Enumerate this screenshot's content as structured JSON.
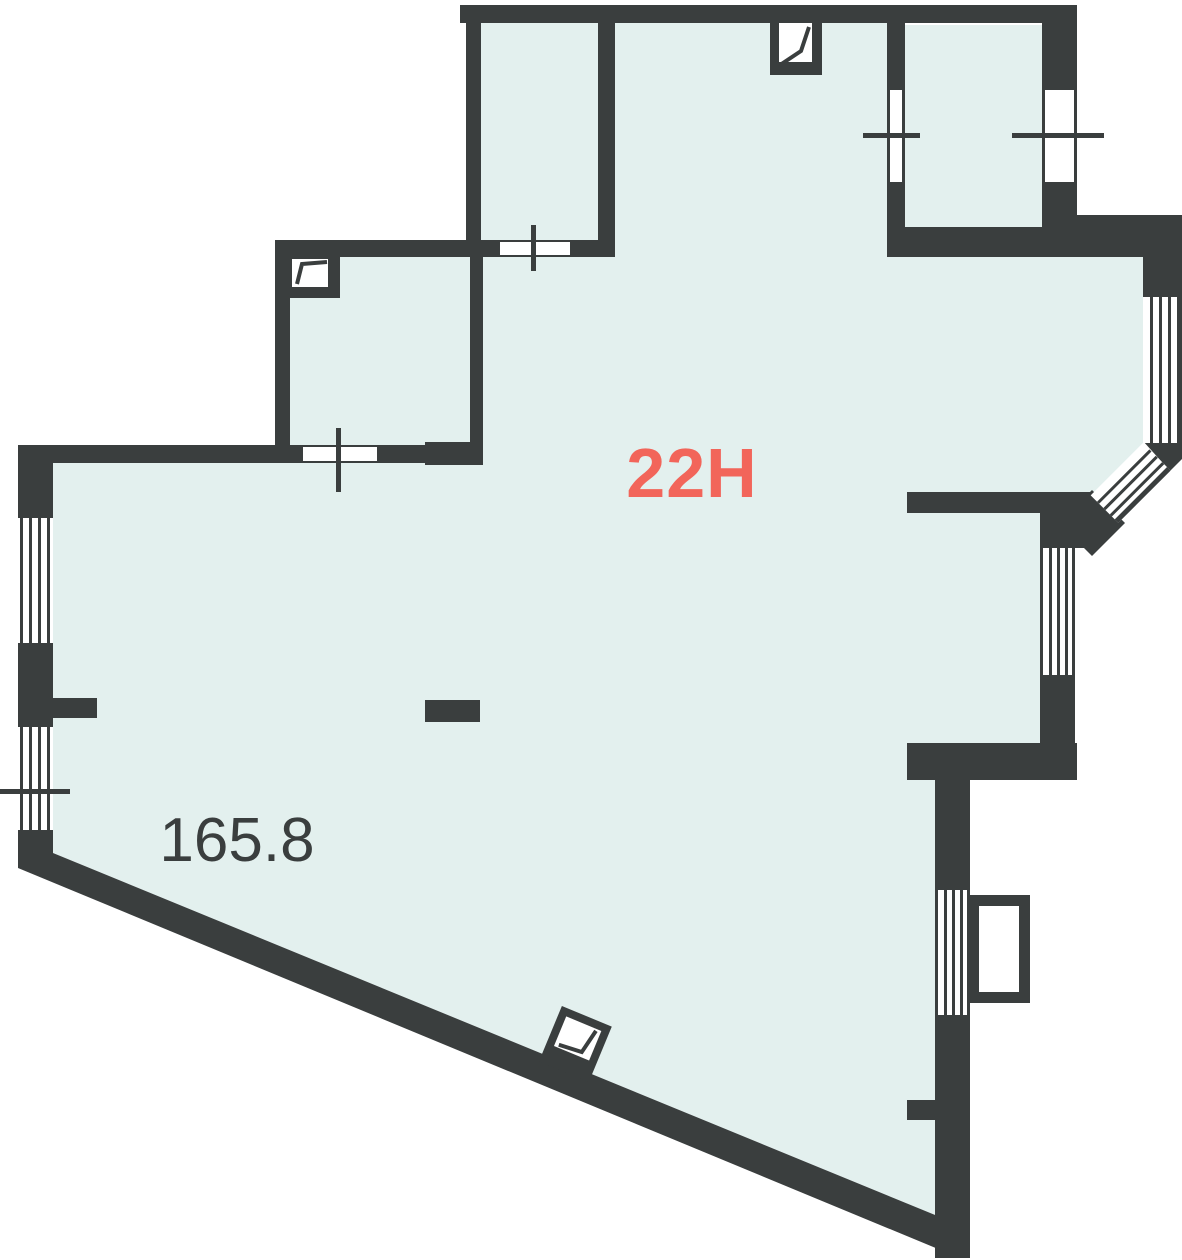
{
  "floor_plan": {
    "unit_label": "22H",
    "area_value": "165.8",
    "colors": {
      "wall": "#3a3e3e",
      "floor": "#e3f0ee",
      "accent": "#f2655a",
      "opening": "#ffffff"
    },
    "icons": [
      "vent-flap-icon-top-wall",
      "vent-flap-icon-small-room",
      "vent-flap-icon-diagonal-wall",
      "window-cross-marks"
    ]
  }
}
